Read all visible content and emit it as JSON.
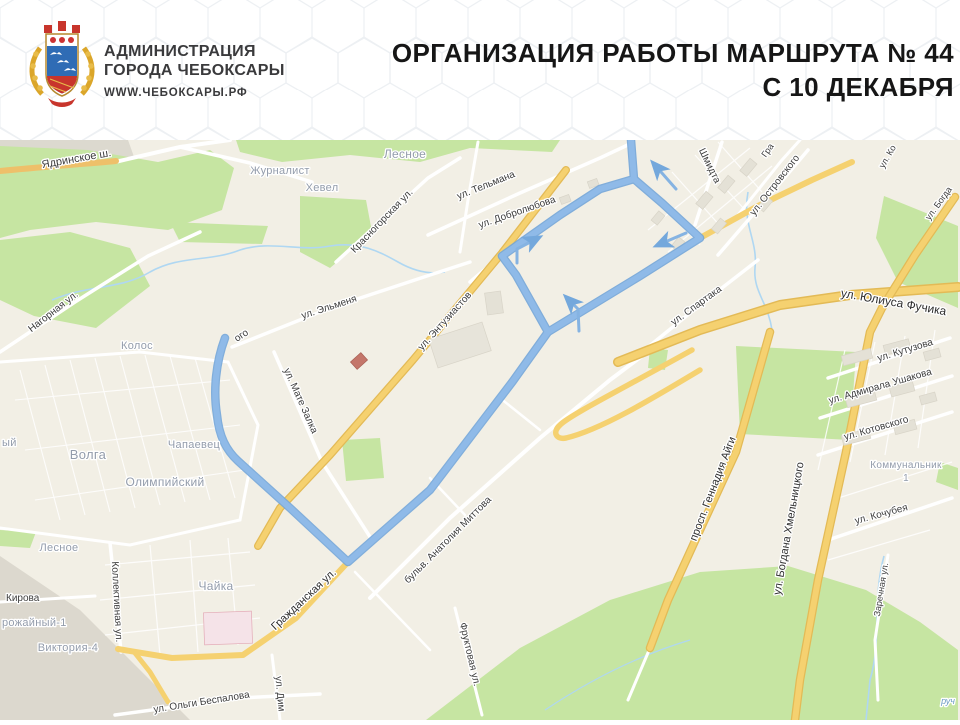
{
  "header": {
    "org_line1": "АДМИНИСТРАЦИЯ",
    "org_line2": "ГОРОДА ЧЕБОКСАРЫ",
    "website": "WWW.ЧЕБОКСАРЫ.РФ",
    "title_line1": "ОРГАНИЗАЦИЯ РАБОТЫ МАРШРУТА № 44",
    "title_line2": "С 10 ДЕКАБРЯ"
  },
  "route": {
    "number": "44",
    "color": "#8fbae8",
    "direction_arrows": 4
  },
  "map": {
    "background_color": "#f2efe5",
    "road_yellow": "#f5d170",
    "green_color": "#c6e5a2",
    "labels": [
      {
        "t": "Ядринское ш.",
        "x": 77,
        "y": 162,
        "r": -10,
        "s": 11,
        "c": "st"
      },
      {
        "t": "Нагорная ул.",
        "x": 55,
        "y": 314,
        "r": -38,
        "s": 10,
        "c": "st"
      },
      {
        "t": "Красногорская ул.",
        "x": 384,
        "y": 223,
        "r": -46,
        "s": 10,
        "c": "st"
      },
      {
        "t": "ул. Тельмана",
        "x": 487,
        "y": 188,
        "r": -22,
        "s": 10,
        "c": "st"
      },
      {
        "t": "ул. Добролюбова",
        "x": 518,
        "y": 215,
        "r": -19,
        "s": 10,
        "c": "st"
      },
      {
        "t": "ул. Эльменя",
        "x": 330,
        "y": 310,
        "r": -18,
        "s": 10,
        "c": "st"
      },
      {
        "t": "ул. Энтузиастов",
        "x": 447,
        "y": 323,
        "r": -48,
        "s": 10,
        "c": "st"
      },
      {
        "t": "ул. Мате Залка",
        "x": 298,
        "y": 402,
        "r": 66,
        "s": 10,
        "c": "st"
      },
      {
        "t": "ого",
        "x": 243,
        "y": 338,
        "r": -33,
        "s": 10,
        "c": "st"
      },
      {
        "t": "ул. Спартака",
        "x": 698,
        "y": 308,
        "r": -36,
        "s": 10,
        "c": "st"
      },
      {
        "t": "Шмидта",
        "x": 707,
        "y": 167,
        "r": 64,
        "s": 10,
        "c": "st"
      },
      {
        "t": "ул. Островского",
        "x": 777,
        "y": 187,
        "r": -52,
        "s": 10,
        "c": "st"
      },
      {
        "t": "Гра",
        "x": 770,
        "y": 152,
        "r": -55,
        "s": 9,
        "c": "st"
      },
      {
        "t": "ул. Юлиуса Фучика",
        "x": 893,
        "y": 306,
        "r": 10,
        "s": 12,
        "c": "mj"
      },
      {
        "t": "ул. Кутузова",
        "x": 906,
        "y": 353,
        "r": -17,
        "s": 10,
        "c": "st"
      },
      {
        "t": "ул. Адмирала Ушакова",
        "x": 881,
        "y": 389,
        "r": -16,
        "s": 10,
        "c": "st"
      },
      {
        "t": "ул. Котовского",
        "x": 877,
        "y": 431,
        "r": -16,
        "s": 10,
        "c": "st"
      },
      {
        "t": "ул. Кочубея",
        "x": 882,
        "y": 517,
        "r": -15,
        "s": 10,
        "c": "st"
      },
      {
        "t": "просп. Геннадия Айги",
        "x": 716,
        "y": 490,
        "r": -69,
        "s": 11,
        "c": "mj"
      },
      {
        "t": "ул. Богдана Хмельницкого",
        "x": 792,
        "y": 529,
        "r": -80,
        "s": 11,
        "c": "mj"
      },
      {
        "t": "Заречная ул.",
        "x": 884,
        "y": 590,
        "r": -81,
        "s": 9,
        "c": "st"
      },
      {
        "t": "Гражданская ул.",
        "x": 306,
        "y": 602,
        "r": -43,
        "s": 11,
        "c": "mj"
      },
      {
        "t": "бульв. Анатолия Миттова",
        "x": 450,
        "y": 542,
        "r": -45,
        "s": 10,
        "c": "st"
      },
      {
        "t": "Коллективная ул.",
        "x": 114,
        "y": 602,
        "r": 87,
        "s": 10,
        "c": "st"
      },
      {
        "t": "Кирова",
        "x": 6,
        "y": 601,
        "r": 0,
        "s": 10,
        "c": "st",
        "a": "start"
      },
      {
        "t": "ул. Ольги Беспалова",
        "x": 202,
        "y": 705,
        "r": -9,
        "s": 10,
        "c": "st"
      },
      {
        "t": "ул. Дим",
        "x": 277,
        "y": 694,
        "r": 85,
        "s": 10,
        "c": "st"
      },
      {
        "t": "Фруктовая ул.",
        "x": 467,
        "y": 655,
        "r": 77,
        "s": 10,
        "c": "st"
      },
      {
        "t": "ул. Ко",
        "x": 890,
        "y": 158,
        "r": -60,
        "s": 9,
        "c": "st"
      },
      {
        "t": "ул. Богда",
        "x": 941,
        "y": 205,
        "r": -54,
        "s": 9,
        "c": "st"
      },
      {
        "t": "Лесное",
        "x": 405,
        "y": 158,
        "r": 0,
        "s": 12,
        "c": "di"
      },
      {
        "t": "Журналист",
        "x": 280,
        "y": 174,
        "r": 0,
        "s": 11,
        "c": "di"
      },
      {
        "t": "Хевел",
        "x": 322,
        "y": 191,
        "r": 0,
        "s": 11,
        "c": "di"
      },
      {
        "t": "Колос",
        "x": 137,
        "y": 349,
        "r": 0,
        "s": 11,
        "c": "di"
      },
      {
        "t": "Волга",
        "x": 88,
        "y": 459,
        "r": 0,
        "s": 13,
        "c": "di"
      },
      {
        "t": "Олимпийский",
        "x": 165,
        "y": 486,
        "r": 0,
        "s": 12,
        "c": "di"
      },
      {
        "t": "Чапаевец",
        "x": 194,
        "y": 448,
        "r": 0,
        "s": 11,
        "c": "di"
      },
      {
        "t": "Чайка",
        "x": 216,
        "y": 590,
        "r": 0,
        "s": 12,
        "c": "di"
      },
      {
        "t": "Лесное",
        "x": 59,
        "y": 551,
        "r": 0,
        "s": 11,
        "c": "di"
      },
      {
        "t": "рожайный-1",
        "x": 2,
        "y": 626,
        "r": 0,
        "s": 11,
        "c": "di",
        "a": "start"
      },
      {
        "t": "Виктория-4",
        "x": 68,
        "y": 651,
        "r": 0,
        "s": 11,
        "c": "di"
      },
      {
        "t": "Коммунальник",
        "x": 906,
        "y": 468,
        "r": 0,
        "s": 10,
        "c": "di"
      },
      {
        "t": "1",
        "x": 906,
        "y": 481,
        "r": 0,
        "s": 10,
        "c": "di"
      },
      {
        "t": "ый",
        "x": 2,
        "y": 446,
        "r": 0,
        "s": 11,
        "c": "di",
        "a": "start"
      },
      {
        "t": "руч",
        "x": 948,
        "y": 704,
        "r": 0,
        "s": 9,
        "c": "wa"
      }
    ]
  }
}
